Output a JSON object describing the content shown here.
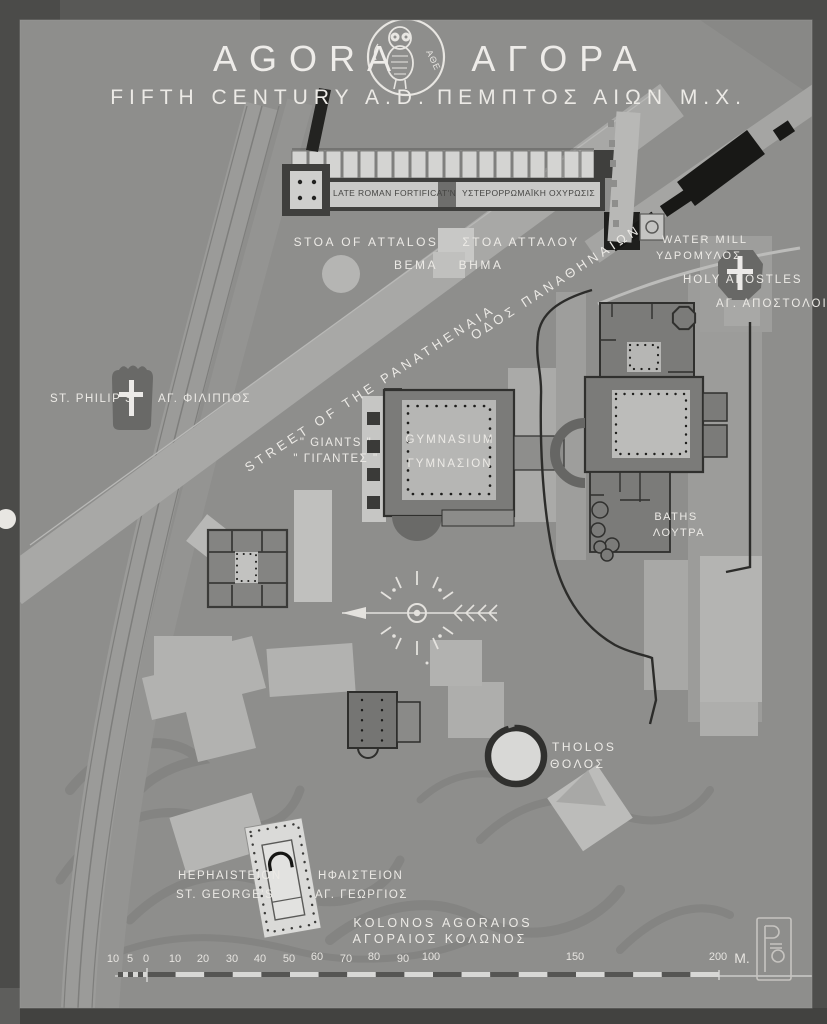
{
  "title": {
    "en": "AGORA",
    "gr": "ΑΓΟΡΑ",
    "subtitle_en": "FIFTH CENTURY A.D.",
    "subtitle_gr": "ΠΕΜΠΤΟΣ ΑΙΩΝ Μ.Χ.",
    "emblem_letters": "ΑΘΕ"
  },
  "labels": {
    "fortification_en": "LATE ROMAN FORTIFICAT'N",
    "fortification_gr": "ΥΣΤΕΡΟΡΡΩΜΑΪΚΗ ΟΧΥΡΩΣΙΣ",
    "stoa_en": "STOA OF ATTALOS",
    "stoa_gr": "ΣΤΟΑ ΑΤΤΑΛΟΥ",
    "bema_en": "BEMA",
    "bema_gr": "ΒΗΜΑ",
    "water_mill_en": "WATER MILL",
    "water_mill_gr": "ΥΔΡΟΜΥΛΟΣ",
    "holy_apostles_en": "HOLY APOSTLES",
    "holy_apostles_gr": "ΑΓ. ΑΠΟΣΤΟΛΟΙ",
    "st_philips_en": "ST. PHILIP'S",
    "st_philips_gr": "ΑΓ. ΦΙΛΙΠΠΟΣ",
    "street_en": "STREET OF THE PANATHENAIA",
    "street_gr": "ΟΔΟΣ ΠΑΝΑΘΗΝΑΙΩΝ",
    "giants_en": "\" GIANTS \"",
    "giants_gr": "\" ΓΙΓΑΝΤΕΣ \"",
    "gymnasium_en": "GYMNASIUM",
    "gymnasium_gr": "ΓΥΜΝΑΣΙΟΝ",
    "baths_en": "BATHS",
    "baths_gr": "ΛΟΥΤΡΑ",
    "tholos_en": "THOLOS",
    "tholos_gr": "ΘΟΛΟΣ",
    "hephaisteion_en1": "HEPHAISTEION",
    "hephaisteion_en2": "ST. GEORGE'S",
    "hephaisteion_gr1": "ΗΦΑΙΣΤΕΙΟΝ",
    "hephaisteion_gr2": "ΑΓ. ΓΕΩΡΓΙΟΣ",
    "kolonos_en": "KOLONOS AGORAIOS",
    "kolonos_gr": "ΑΓΟΡΑΙΟΣ ΚΟΛΩΝΟΣ"
  },
  "scale_bar": {
    "ticks": [
      "10",
      "5",
      "0",
      "10",
      "20",
      "30",
      "40",
      "50",
      "60",
      "70",
      "80",
      "90",
      "100",
      "150",
      "200"
    ],
    "unit": "M."
  },
  "colors": {
    "map_bg": "#8e8e8c",
    "road_light": "#a8a8a6",
    "building_mid": "#7b7b79",
    "building_light": "#b6b6b4",
    "wall_black": "#1c1c1a",
    "text_white": "#eceae6"
  }
}
